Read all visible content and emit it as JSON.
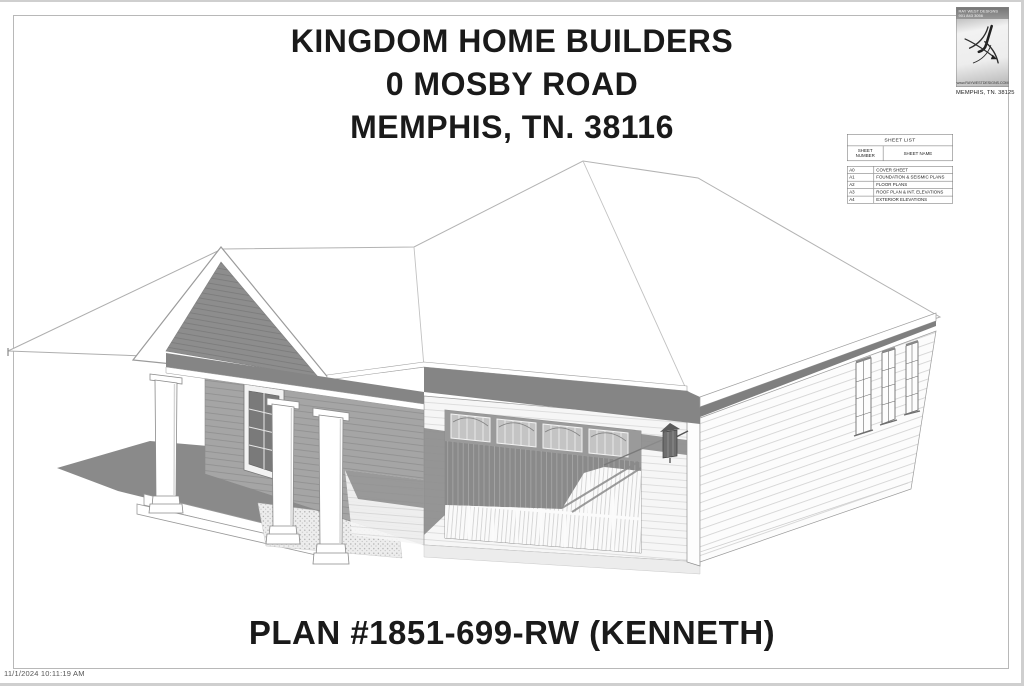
{
  "sheet": {
    "timestamp": "11/1/2024 10:11:19 AM"
  },
  "title_block": {
    "line1": "KINGDOM HOME BUILDERS",
    "line2": "0 MOSBY ROAD",
    "line3": "MEMPHIS, TN. 38116"
  },
  "plan_label": "PLAN #1851-699-RW (KENNETH)",
  "sheet_list": {
    "title": "SHEET LIST",
    "col_number": "SHEET NUMBER",
    "col_name": "SHEET NAME",
    "rows": [
      {
        "number": "A0",
        "name": "COVER SHEET"
      },
      {
        "number": "A1",
        "name": "FOUNDATION & SEISMIC PLANS"
      },
      {
        "number": "A2",
        "name": "FLOOR PLANS"
      },
      {
        "number": "A3",
        "name": "ROOF PLAN & INT. ELEVATIONS"
      },
      {
        "number": "A4",
        "name": "EXTERIOR ELEVATIONS"
      }
    ]
  },
  "designer_stamp": {
    "line1": "RAY WEST DESIGNS",
    "line2": "901 843 3056",
    "website": "www.RAYWESTDESIGNS.COM",
    "location": "MEMPHIS, TN. 38125"
  },
  "drawing": {
    "description": "3D perspective rendering of a single-story house with gabled front porch, double garage and hip roof"
  },
  "colors": {
    "page": "#ffffff",
    "shadow_gray": "#8a8a8a",
    "line_gray": "#9a9a9a",
    "text_dark": "#1a1a1a"
  }
}
